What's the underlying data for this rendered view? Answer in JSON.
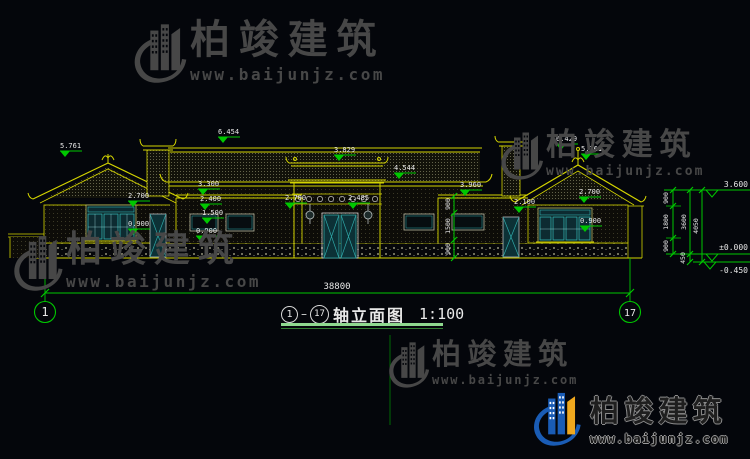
{
  "watermark": {
    "brand": "柏竣建筑",
    "url": "www.baijunjz.com"
  },
  "colors": {
    "background": "#04060b",
    "line_yellow": "#d4d400",
    "dim_green": "#00c800",
    "window_teal": "#2fa8a8",
    "text_white": "#e8e8e8",
    "watermark_gray": "#474747",
    "logo_blue": "#1a5cb5",
    "logo_yellow": "#f0a81e"
  },
  "drawing": {
    "total_width": "38800",
    "axis_start": "1",
    "axis_end": "17",
    "title": {
      "from": "1",
      "sep": "–",
      "to": "17",
      "name": "轴立面图",
      "scale": "1:100"
    },
    "marks": [
      {
        "value": "5.761"
      },
      {
        "value": "6.454"
      },
      {
        "value": "3.829"
      },
      {
        "value": "4.544"
      },
      {
        "value": "3.960"
      },
      {
        "value": "3.300"
      },
      {
        "value": "2.400"
      },
      {
        "value": "1.500"
      },
      {
        "value": "0.900"
      },
      {
        "value": "2.700"
      },
      {
        "value": "0.900"
      },
      {
        "value": "2.700"
      },
      {
        "value": "2.485"
      },
      {
        "value": "2.100"
      },
      {
        "value": "2.700"
      },
      {
        "value": "0.900"
      },
      {
        "value": "6.429"
      },
      {
        "value": "5.761"
      }
    ],
    "window_dims": [
      {
        "value": "900"
      },
      {
        "value": "1500"
      },
      {
        "value": "900"
      }
    ],
    "right_dims": {
      "segments": [
        {
          "value": "900"
        },
        {
          "value": "1800"
        },
        {
          "value": "900"
        },
        {
          "value": "450"
        }
      ],
      "totals": [
        {
          "value": "3600"
        },
        {
          "value": "4050"
        }
      ],
      "levels": [
        {
          "value": "3.600"
        },
        {
          "value": "±0.000"
        },
        {
          "value": "-0.450"
        }
      ]
    }
  }
}
